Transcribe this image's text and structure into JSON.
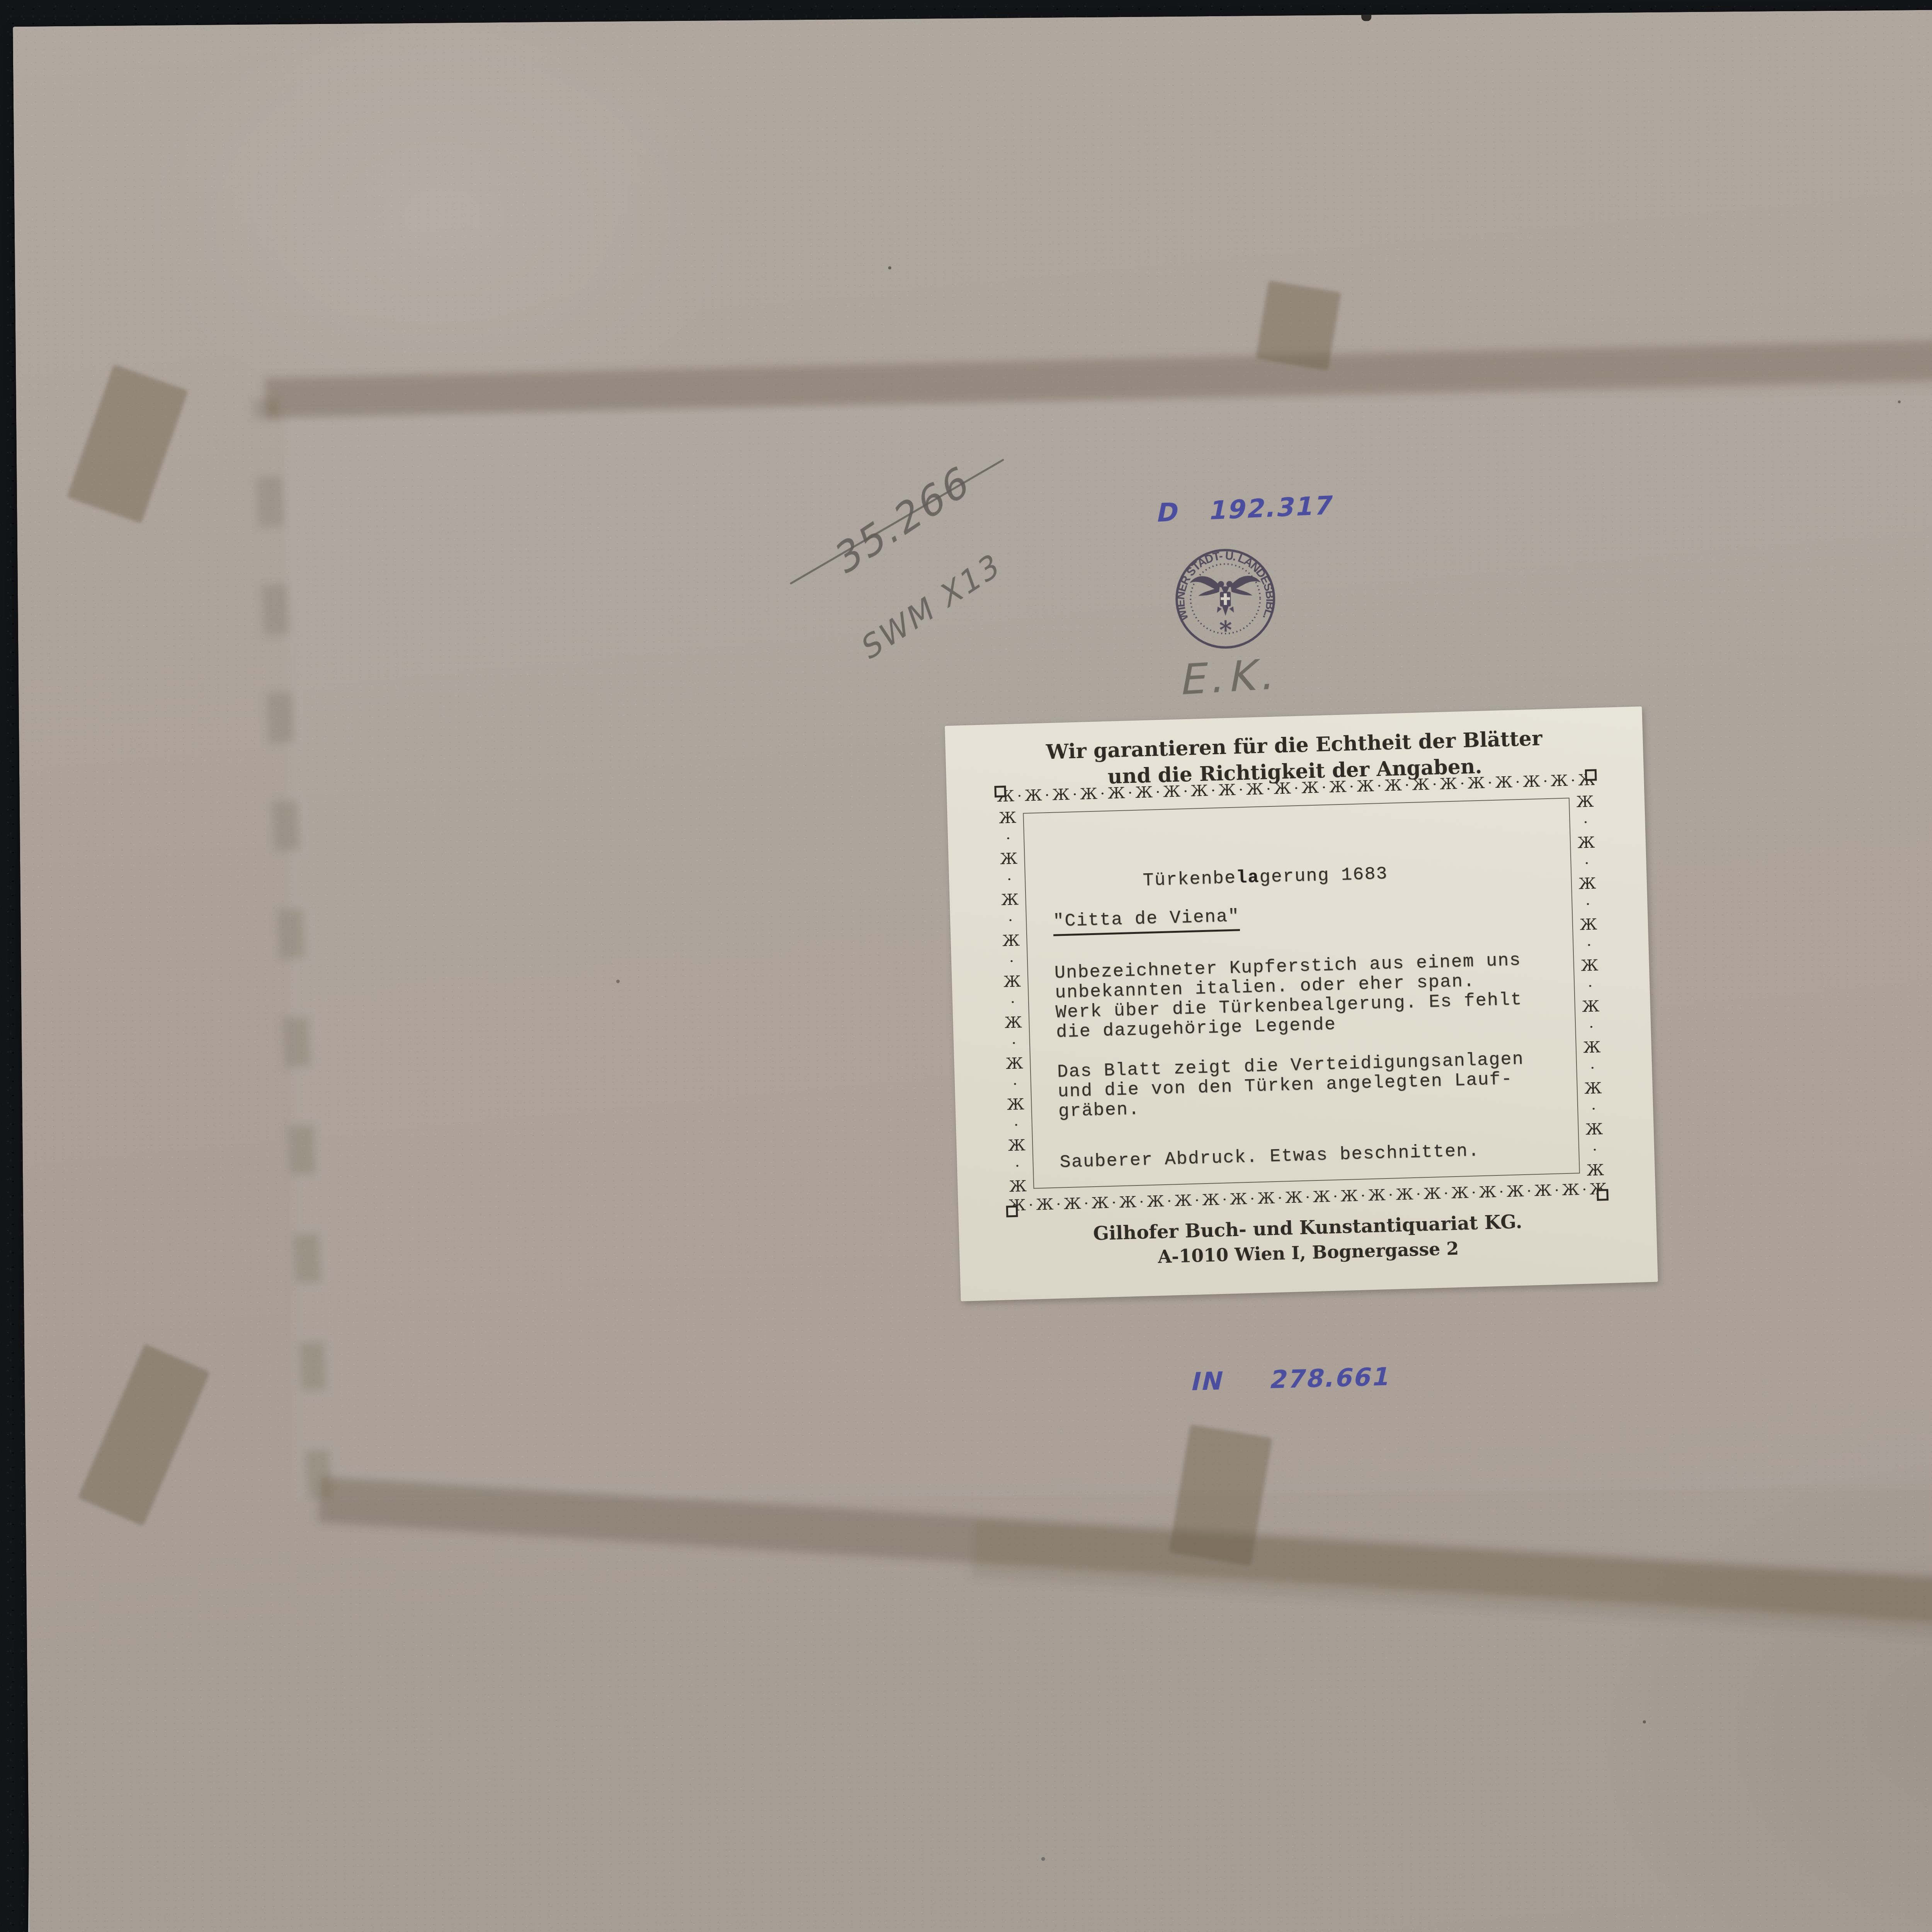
{
  "scene": {
    "description": "verso of mounted engraving on gray cardboard",
    "colors": {
      "leather_background": "#131417",
      "cardboard": "#aba29a",
      "tissue_sheet": "#d4d7d9",
      "label_paper": "#e3dfd2",
      "print_dark": "#2e2a24",
      "typewriter": "#36302a",
      "ink_blue": "#4b4d9e",
      "pencil_gray": "#6c6761",
      "stamp_violet": "#453e51",
      "ghost_stain": "#64573f"
    }
  },
  "annotations": {
    "pencil_number": "35.266",
    "pencil_shelfmark": "SWM X13",
    "ink_top_prefix": "D",
    "ink_top_number": "192.317",
    "librarian_initials": "E.K.",
    "ink_bottom_prefix": "IN",
    "ink_bottom_number": "278.661"
  },
  "stamp": {
    "circular_text": "WIENER STADT- U. LANDESBIBL.",
    "star": "*"
  },
  "label": {
    "header_line1": "Wir garantieren f\u00fcr die Echtheit der Bl\u00e4tter",
    "header_line2": "und die Richtigkeit der Angaben.",
    "title_prefix": "T\u00fcrkenbe",
    "title_overstrike": "la",
    "title_suffix": "gerung 1683",
    "subtitle": "\"Citta de Viena\"",
    "para1_lines": [
      "Unbezeichneter Kupferstich aus einem uns",
      "unbekannten italien. oder eher span.",
      "Werk \u00fcber die T\u00fcrkenbealgerung. Es fehlt",
      "die dazugeh\u00f6rige Legende"
    ],
    "para2_lines": [
      "Das Blatt zeigt die Verteidigungsanlagen",
      "und die von den T\u00fcrken angelegten Lauf-",
      "gr\u00e4ben."
    ],
    "note": "Sauberer Abdruck. Etwas beschnitten.",
    "footer_line1": "Gilhofer Buch- und Kunstantiquariat KG.",
    "footer_line2": "A-1010 Wien I, Bognergasse 2",
    "ornament": {
      "unit": "\u0416"
    }
  }
}
